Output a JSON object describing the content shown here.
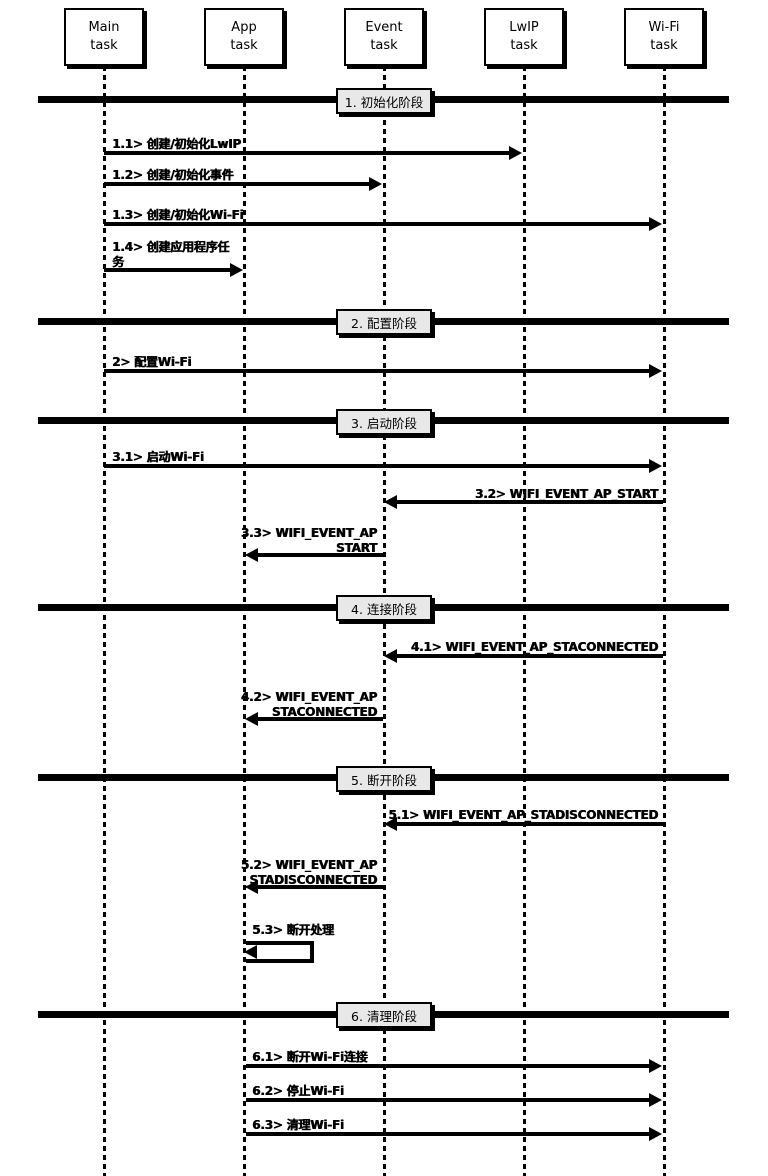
{
  "diagram": {
    "type": "sequence-diagram",
    "actors": [
      {
        "name": "Main task",
        "label": "Main\ntask"
      },
      {
        "name": "App task",
        "label": "App\ntask"
      },
      {
        "name": "Event task",
        "label": "Event\ntask"
      },
      {
        "name": "LwIP task",
        "label": "LwIP\ntask"
      },
      {
        "name": "Wi-Fi task",
        "label": "Wi-Fi\ntask"
      }
    ],
    "phases": [
      {
        "label": "1. 初始化阶段"
      },
      {
        "label": "2. 配置阶段"
      },
      {
        "label": "3. 启动阶段"
      },
      {
        "label": "4. 连接阶段"
      },
      {
        "label": "5. 断开阶段"
      },
      {
        "label": "6. 清理阶段"
      }
    ],
    "messages": [
      {
        "label": "1.1> 创建/初始化LwIP",
        "from": "Main task",
        "to": "LwIP task"
      },
      {
        "label": "1.2> 创建/初始化事件",
        "from": "Main task",
        "to": "Event task"
      },
      {
        "label": "1.3> 创建/初始化Wi-Fi",
        "from": "Main task",
        "to": "Wi-Fi task"
      },
      {
        "label": "1.4> 创建应用程序任\n务",
        "from": "Main task",
        "to": "App task"
      },
      {
        "label": "2> 配置Wi-Fi",
        "from": "Main task",
        "to": "Wi-Fi task"
      },
      {
        "label": "3.1> 启动Wi-Fi",
        "from": "Main task",
        "to": "Wi-Fi task"
      },
      {
        "label": "3.2> WIFI_EVENT_AP_START",
        "from": "Wi-Fi task",
        "to": "Event task"
      },
      {
        "label": "3.3> WIFI_EVENT_AP\n_START",
        "from": "Event task",
        "to": "App task"
      },
      {
        "label": "4.1> WIFI_EVENT_AP_STACONNECTED",
        "from": "Wi-Fi task",
        "to": "Event task"
      },
      {
        "label": "4.2> WIFI_EVENT_AP\n_STACONNECTED",
        "from": "Event task",
        "to": "App task"
      },
      {
        "label": "5.1> WIFI_EVENT_AP_STADISCONNECTED",
        "from": "Wi-Fi task",
        "to": "Event task"
      },
      {
        "label": "5.2> WIFI_EVENT_AP\n_STADISCONNECTED",
        "from": "Event task",
        "to": "App task"
      },
      {
        "label": "5.3> 断开处理",
        "from": "App task",
        "to": "App task"
      },
      {
        "label": "6.1> 断开Wi-Fi连接",
        "from": "App task",
        "to": "Wi-Fi task"
      },
      {
        "label": "6.2> 停止Wi-Fi",
        "from": "App task",
        "to": "Wi-Fi task"
      },
      {
        "label": "6.3> 清理Wi-Fi",
        "from": "App task",
        "to": "Wi-Fi task"
      }
    ],
    "colors": {
      "background": "#ffffff",
      "line": "#000000",
      "phase_label_bg": "#e8e8e8"
    }
  }
}
